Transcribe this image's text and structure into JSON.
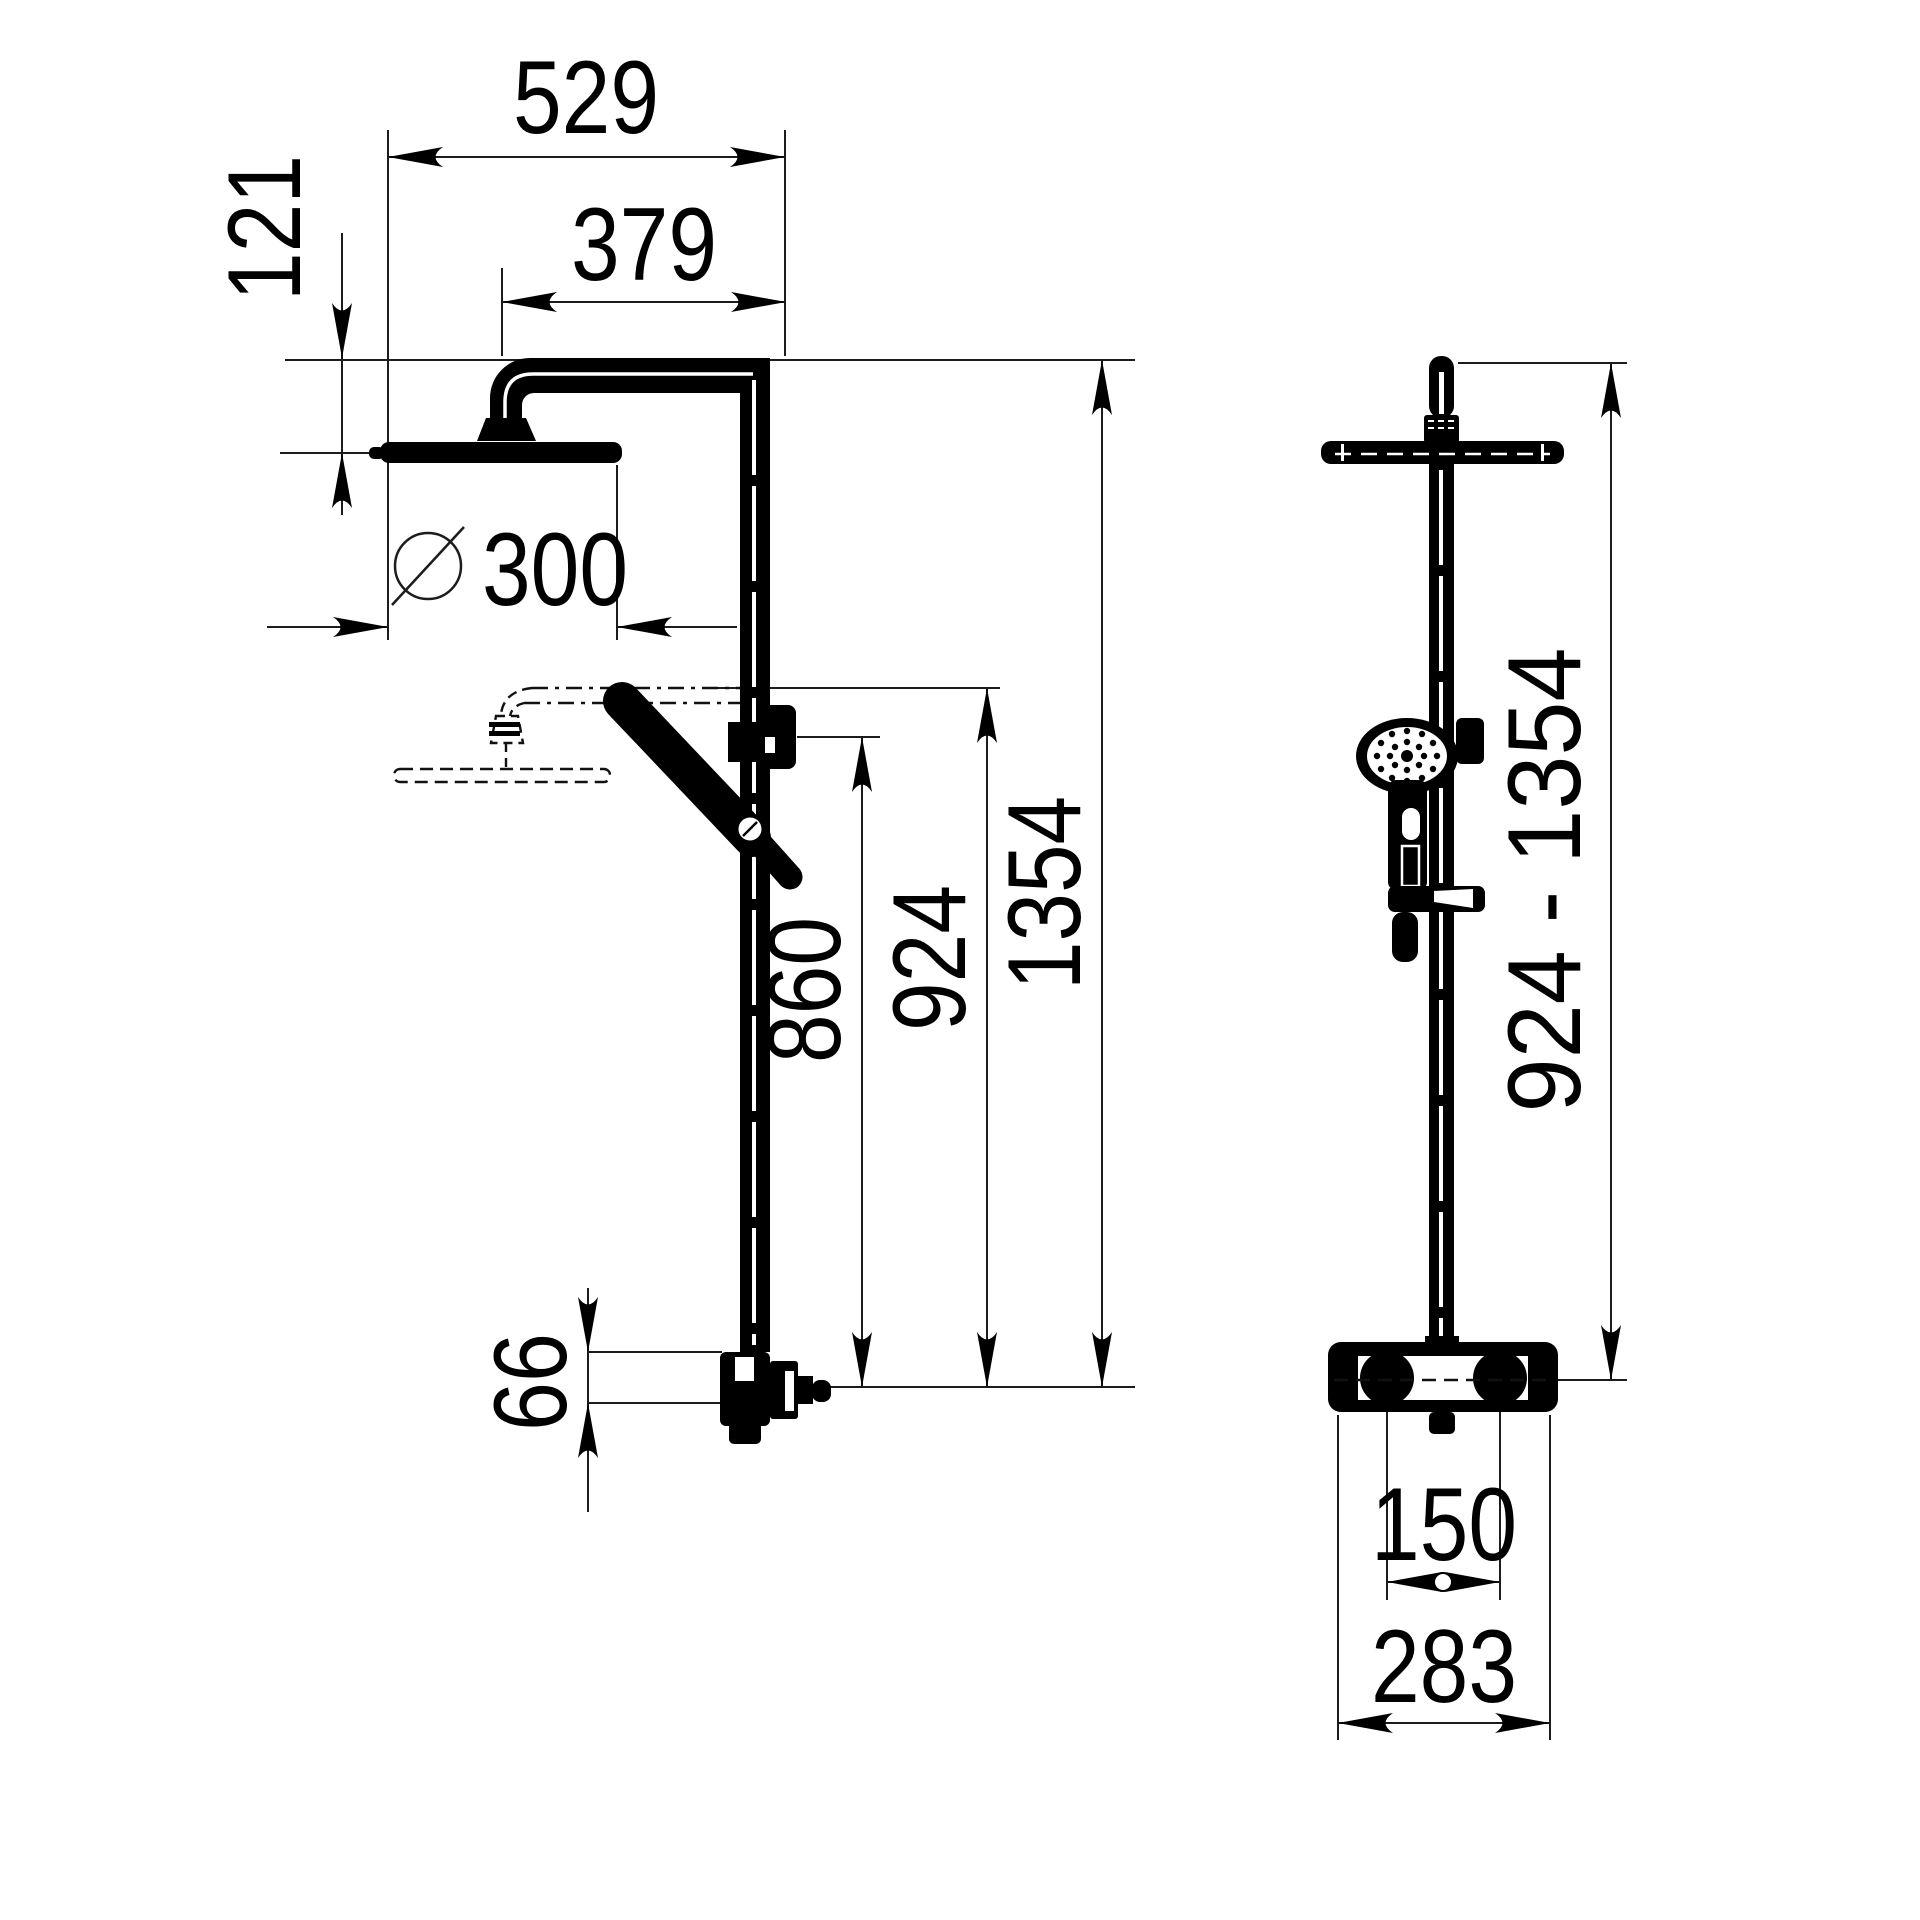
{
  "front_view": {
    "label_total_width": "529",
    "label_arm_reach": "379",
    "label_head_offset": "121",
    "label_head_diameter": "300",
    "label_rail_height": "860",
    "label_min_height": "924",
    "label_total_height": "1354",
    "label_outlet_offset": "66"
  },
  "side_view": {
    "label_height_range": "924 - 1354",
    "label_connection_distance": "150",
    "label_total_width": "283"
  }
}
